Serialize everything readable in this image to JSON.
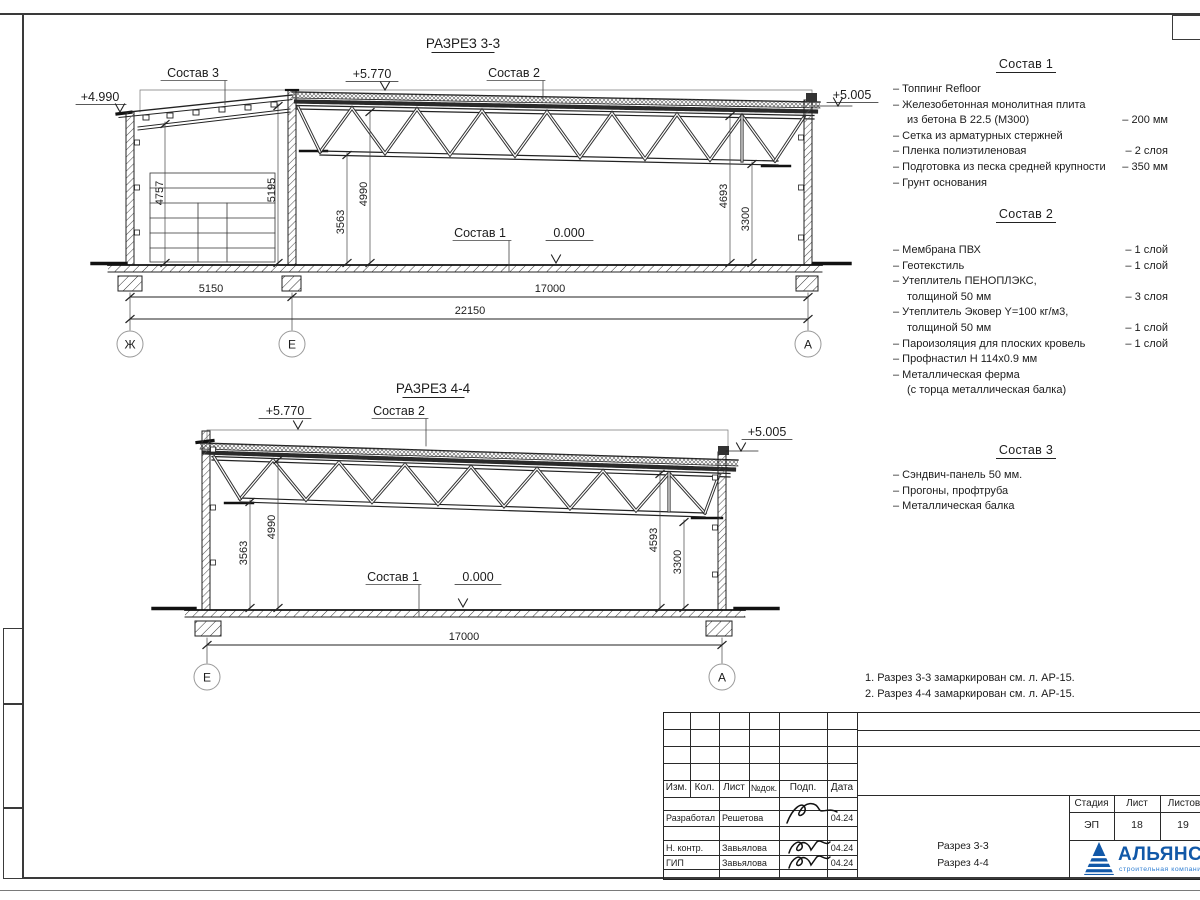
{
  "s33": {
    "title": "РАЗРЕЗ 3-3",
    "sostav3": "Состав 3",
    "sostav2": "Состав 2",
    "sostav1": "Состав 1",
    "elev_left": "+4.990",
    "elev_mid": "+5.770",
    "elev_right": "+5.005",
    "floor": "0.000",
    "d4757": "4757",
    "d5195": "5195",
    "d3563": "3563",
    "d4990": "4990",
    "d4693": "4693",
    "d3300": "3300",
    "h5150": "5150",
    "h17000": "17000",
    "h22150": "22150",
    "axis_zh": "Ж",
    "axis_e": "Е",
    "axis_a": "А"
  },
  "s44": {
    "title": "РАЗРЕЗ 4-4",
    "sostav2": "Состав 2",
    "sostav1": "Состав 1",
    "elev_left": "+5.770",
    "elev_right": "+5.005",
    "floor": "0.000",
    "d3563": "3563",
    "d4990": "4990",
    "d4593": "4593",
    "d3300": "3300",
    "h17000": "17000",
    "axis_e": "Е",
    "axis_a": "А"
  },
  "comp1": {
    "title": "Состав 1",
    "items": [
      {
        "t": "– Топпинг Refloor",
        "v": ""
      },
      {
        "t": "– Железобетонная  монолитная плита",
        "v": ""
      },
      {
        "t": "из бетона В 22.5 (М300)",
        "v": "– 200 мм"
      },
      {
        "t": "– Сетка из арматурных стержней",
        "v": ""
      },
      {
        "t": "– Пленка полиэтиленовая",
        "v": "– 2 слоя"
      },
      {
        "t": "– Подготовка из песка средней крупности",
        "v": "– 350 мм"
      },
      {
        "t": "– Грунт основания",
        "v": ""
      }
    ]
  },
  "comp2": {
    "title": "Состав 2",
    "items": [
      {
        "t": "– Мембрана ПВХ",
        "v": "– 1 слой"
      },
      {
        "t": "– Геотекстиль",
        "v": "– 1 слой"
      },
      {
        "t": "– Утеплитель ПЕНОПЛЭКС,",
        "v": ""
      },
      {
        "t": "толщиной 50 мм",
        "v": "– 3 слоя"
      },
      {
        "t": "– Утеплитель Эковер Y=100 кг/м3,",
        "v": ""
      },
      {
        "t": "толщиной 50 мм",
        "v": "– 1 слой"
      },
      {
        "t": "– Пароизоляция для плоских кровель",
        "v": "– 1 слой"
      },
      {
        "t": "– Профнастил Н 114х0.9 мм",
        "v": ""
      },
      {
        "t": "– Металлическая ферма",
        "v": ""
      },
      {
        "t": "(с торца металлическая балка)",
        "v": ""
      }
    ]
  },
  "comp3": {
    "title": "Состав 3",
    "items": [
      {
        "t": "– Сэндвич-панель 50 мм.",
        "v": ""
      },
      {
        "t": "– Прогоны, профтруба",
        "v": ""
      },
      {
        "t": "– Металлическая балка",
        "v": ""
      }
    ]
  },
  "notes": {
    "n1": "1. Разрез 3-3 замаркирован см. л. АР-15.",
    "n2": "2. Разрез 4-4 замаркирован см. л. АР-15."
  },
  "tb": {
    "h_izm": "Изм.",
    "h_kol": "Кол.",
    "h_list": "Лист",
    "h_ndok": "№док.",
    "h_podp": "Подп.",
    "h_data": "Дата",
    "r1_role": "Разработал",
    "r1_name": "Решетова",
    "r1_date": "04.24",
    "r2_role": "Н. контр.",
    "r2_name": "Завьялова",
    "r2_date": "04.24",
    "r3_role": "ГИП",
    "r3_name": "Завьялова",
    "r3_date": "04.24",
    "title1": "Разрез 3-3",
    "title2": "Разрез 4-4",
    "stage_h": "Стадия",
    "sheet_h": "Лист",
    "sheets_h": "Листов",
    "stage": "ЭП",
    "sheet": "18",
    "sheets": "19"
  },
  "logo": {
    "name": "АЛЬЯНС",
    "subtitle": "строительная компания",
    "color": "#1158a8"
  }
}
